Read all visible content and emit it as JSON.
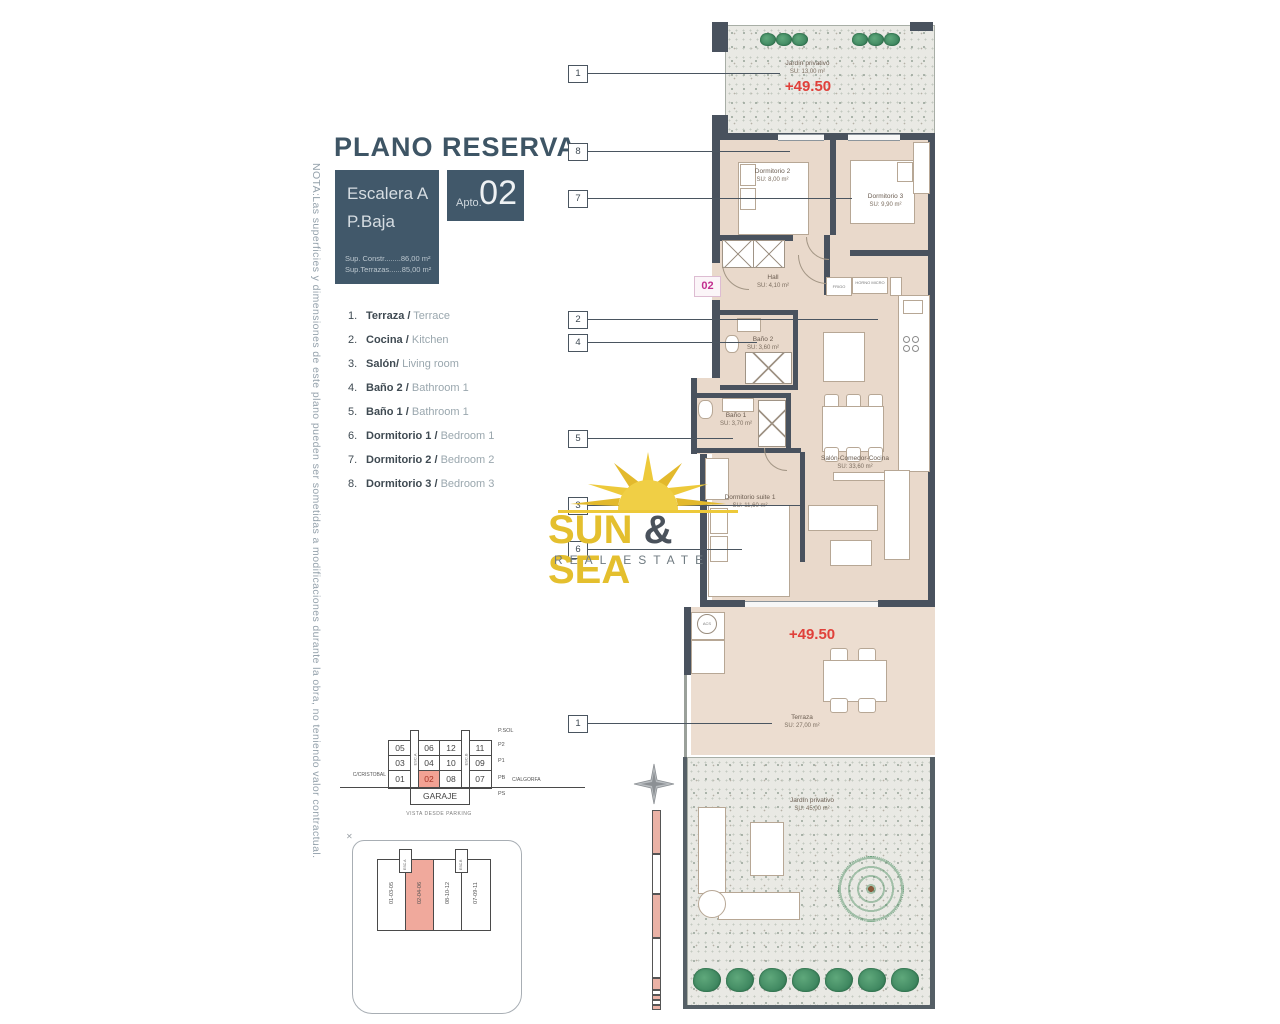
{
  "title": "PLANO RESERVA",
  "note": "NOTA:Las superficies y dimensiones de este plano pueden ser sometidas a modificaciones durante la obra, no teniendo valor contractual.",
  "header": {
    "escalera": "Escalera A",
    "planta": "P.Baja",
    "sup_constr": "Sup. Constr........86,00 m²",
    "sup_terrazas": "Sup.Terrazas......85,00 m²",
    "apto_label": "Apto.",
    "apto_number": "02"
  },
  "legend": {
    "items": [
      {
        "num": "1.",
        "es": "Terraza /",
        "en": "Terrace"
      },
      {
        "num": "2.",
        "es": "Cocina /",
        "en": "Kitchen"
      },
      {
        "num": "3.",
        "es": "Salón/",
        "en": "Living room"
      },
      {
        "num": "4.",
        "es": "Baño 2 /",
        "en": "Bathroom 1"
      },
      {
        "num": "5.",
        "es": "Baño 1 /",
        "en": "Bathroom 1"
      },
      {
        "num": "6.",
        "es": "Dormitorio 1 /",
        "en": "Bedroom 1"
      },
      {
        "num": "7.",
        "es": "Dormitorio 2 /",
        "en": "Bedroom 2"
      },
      {
        "num": "8.",
        "es": "Dormitorio 3 /",
        "en": "Bedroom 3"
      }
    ]
  },
  "plan": {
    "unit_marker": "02",
    "elevation_top": "+49.50",
    "elevation_terrace": "+49.50",
    "rooms": {
      "jardin_top": {
        "name": "Jardín privativo",
        "su": "SU: 13,00 m²"
      },
      "dorm2": {
        "name": "Dormitorio 2",
        "su": "SU: 8,00 m²"
      },
      "dorm3": {
        "name": "Dormitorio 3",
        "su": "SU: 9,90 m²"
      },
      "hall": {
        "name": "Hall",
        "su": "SU: 4,10 m²"
      },
      "bano2": {
        "name": "Baño 2",
        "su": "SU: 3,60 m²"
      },
      "bano1": {
        "name": "Baño 1",
        "su": "SU: 3,70 m²"
      },
      "salon": {
        "name": "Salón-Comedor-Cocina",
        "su": "SU: 33,60 m²"
      },
      "suite": {
        "name": "Dormitorio suite 1",
        "su": "SU: 11,60 m²"
      },
      "terraza": {
        "name": "Terraza",
        "su": "SU: 27,00 m²"
      },
      "jardin_bottom": {
        "name": "Jardín privativo",
        "su": "SU: 45,00 m²"
      }
    },
    "labels": {
      "frigo": "FRIGO",
      "horno": "HORNO MICRO",
      "acs": "ACS"
    },
    "callouts": [
      "1",
      "8",
      "7",
      "2",
      "4",
      "5",
      "3",
      "6",
      "1"
    ]
  },
  "logo": {
    "sun": "SUN",
    "amp": " & ",
    "sea": "SEA",
    "tagline": "REAL ESTATE"
  },
  "garage": {
    "rows": [
      [
        "05",
        "06",
        "12",
        "11"
      ],
      [
        "03",
        "04",
        "10",
        "09"
      ],
      [
        "01",
        "02",
        "08",
        "07"
      ]
    ],
    "highlighted": "02",
    "garaje": "GARAJE",
    "floors": [
      "P.SOL",
      "P2",
      "P1",
      "PB",
      "PS"
    ],
    "street_left_1": "C/CRISTOBAL",
    "street_left_2": "COLÓN",
    "street_right": "C/ALGORFA",
    "stair_left": "ESC.A",
    "stair_right": "ESC.B",
    "caption": "VISTA DESDE PARKING"
  },
  "siteplan": {
    "blocks": [
      "01-03-05",
      "02-04-06",
      "08-10-12",
      "07-09-11"
    ],
    "highlighted": "02-04-06",
    "stair_a": "ESC.A",
    "stair_b": "ESC.B"
  },
  "colors": {
    "slate": "#41586a",
    "wall": "#49525e",
    "floor": "#e9d9cb",
    "red": "#e0403a",
    "magenta": "#c2308f",
    "highlight": "#f2a294",
    "logo_yellow": "#e4bf2e",
    "green": "#4e9468"
  }
}
